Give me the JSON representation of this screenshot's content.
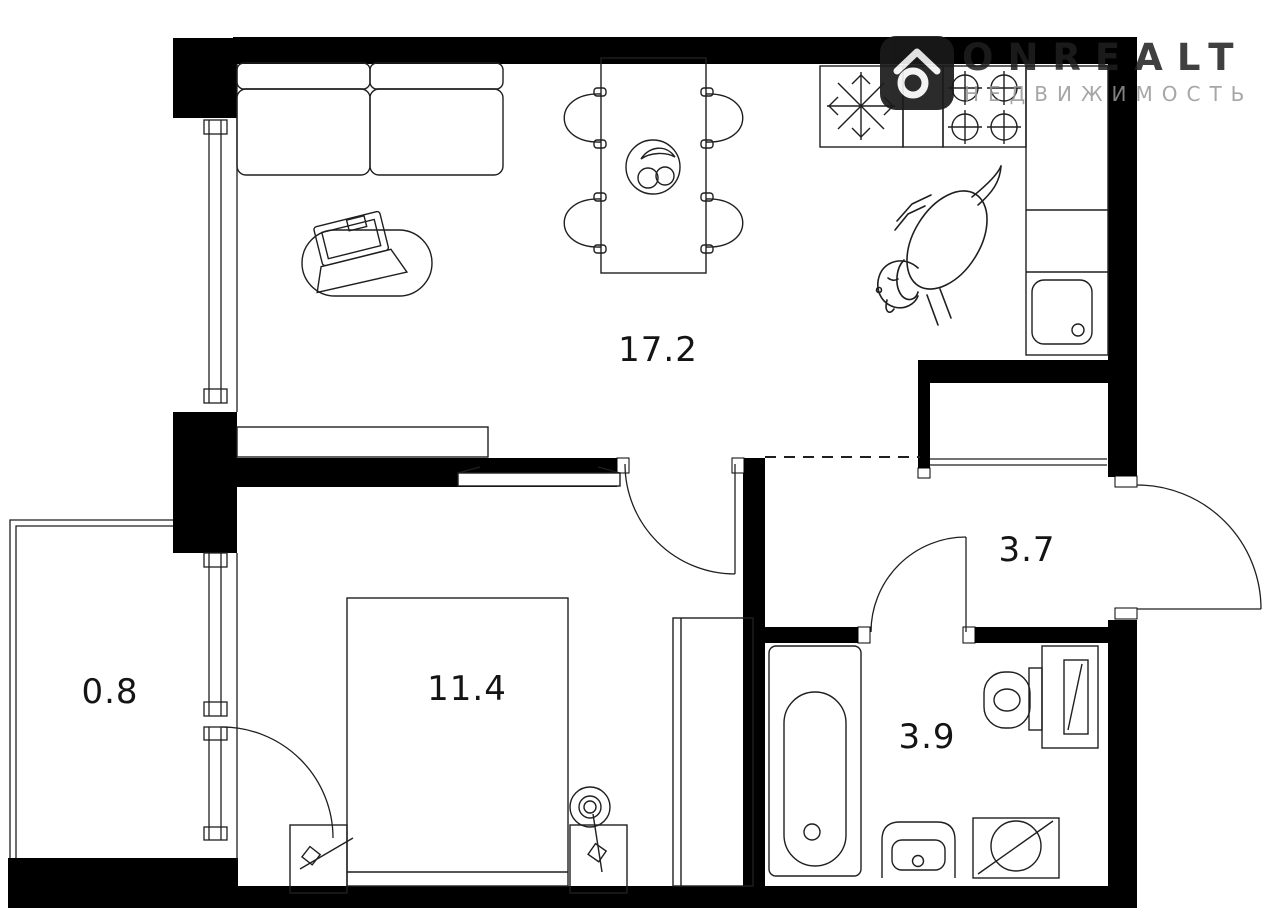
{
  "watermark": {
    "brand": "ONREALT",
    "tagline": "НЕДВИЖИМОСТЬ"
  },
  "rooms": [
    {
      "name": "living-room-kitchen",
      "area": "17.2"
    },
    {
      "name": "bedroom",
      "area": "11.4"
    },
    {
      "name": "hallway",
      "area": "3.7"
    },
    {
      "name": "bathroom",
      "area": "3.9"
    },
    {
      "name": "balcony",
      "area": "0.8"
    }
  ],
  "colors": {
    "walls": "#000000",
    "lines": "#1f1f1f",
    "background": "#ffffff",
    "watermark_brand": "#1e1e1e",
    "watermark_tagline": "#969696"
  }
}
